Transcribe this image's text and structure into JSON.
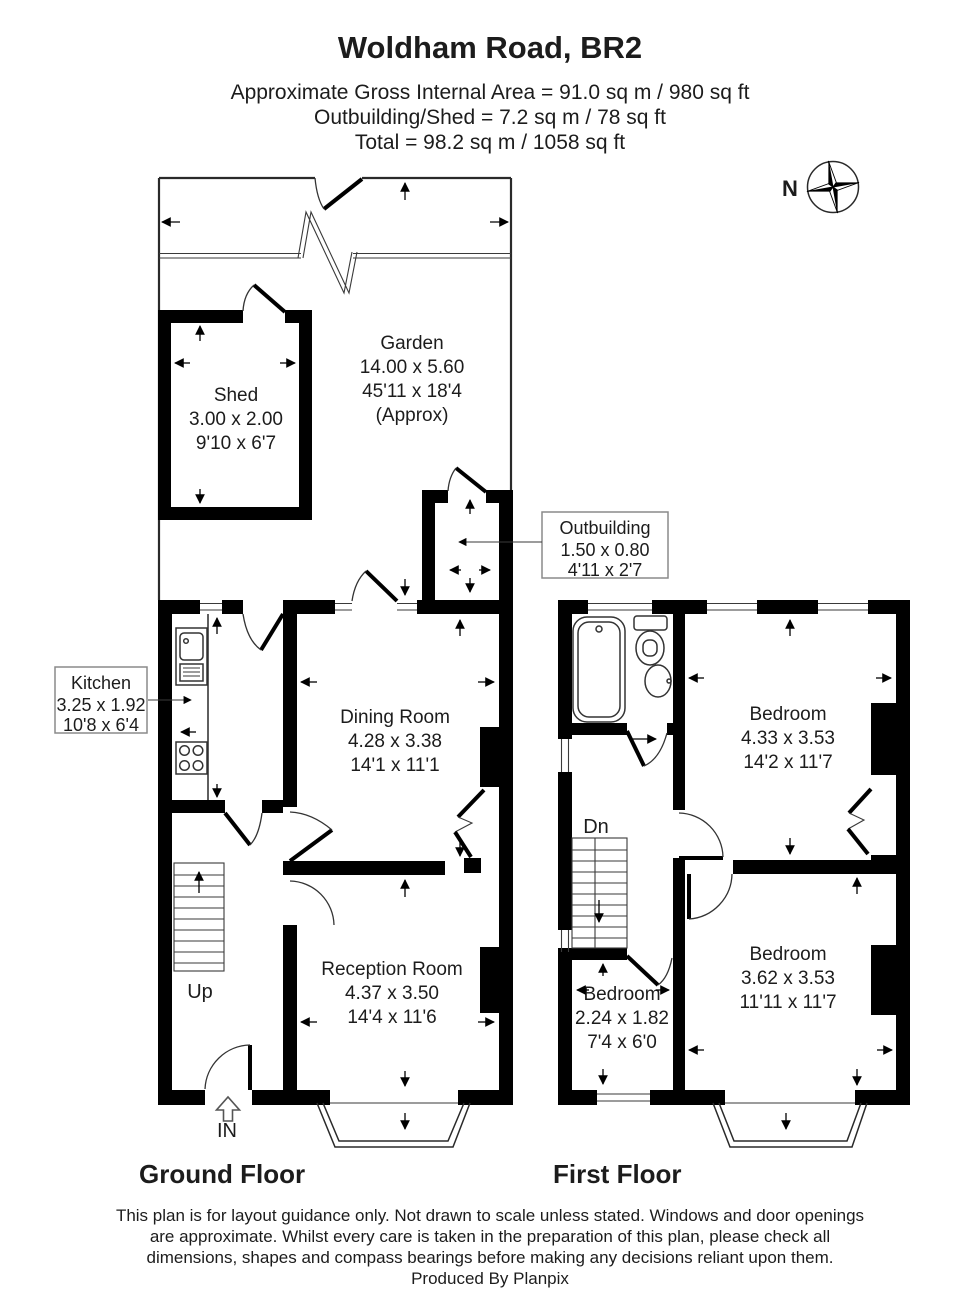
{
  "page": {
    "background": "#ffffff",
    "wall_color": "#000000",
    "line_color": "#222222",
    "box_border_color": "#8a8a8a"
  },
  "header": {
    "title": "Woldham Road, BR2",
    "area_lines": [
      "Approximate Gross Internal Area = 91.0 sq m / 980 sq ft",
      "Outbuilding/Shed = 7.2 sq m / 78 sq ft",
      "Total = 98.2 sq m / 1058 sq ft"
    ]
  },
  "compass": {
    "north_label": "N"
  },
  "ground": {
    "floor_label": "Ground Floor",
    "garden": {
      "name": "Garden",
      "metric": "14.00 x 5.60",
      "imperial": "45'11 x 18'4",
      "note": "(Approx)"
    },
    "shed": {
      "name": "Shed",
      "metric": "3.00 x 2.00",
      "imperial": "9'10 x 6'7"
    },
    "outbuilding": {
      "name": "Outbuilding",
      "metric": "1.50 x 0.80",
      "imperial": "4'11 x 2'7"
    },
    "kitchen": {
      "name": "Kitchen",
      "metric": "3.25 x 1.92",
      "imperial": "10'8 x 6'4"
    },
    "dining": {
      "name": "Dining Room",
      "metric": "4.28 x 3.38",
      "imperial": "14'1 x 11'1"
    },
    "reception": {
      "name": "Reception Room",
      "metric": "4.37 x 3.50",
      "imperial": "14'4 x 11'6"
    },
    "up_label": "Up",
    "in_label": "IN"
  },
  "first": {
    "floor_label": "First Floor",
    "bedroom_front": {
      "name": "Bedroom",
      "metric": "4.33 x 3.53",
      "imperial": "14'2 x 11'7"
    },
    "bedroom_back": {
      "name": "Bedroom",
      "metric": "3.62 x 3.53",
      "imperial": "11'11 x 11'7"
    },
    "bedroom_small": {
      "name": "Bedroom",
      "metric": "2.24 x 1.82",
      "imperial": "7'4 x 6'0"
    },
    "dn_label": "Dn"
  },
  "footer": {
    "disclaimer_lines": [
      "This plan is for layout guidance only. Not drawn to scale unless stated. Windows and door openings",
      "are approximate. Whilst every care is taken in the preparation of this plan, please check all",
      "dimensions, shapes and compass bearings before making any decisions reliant upon them.",
      "Produced By Planpix"
    ]
  }
}
